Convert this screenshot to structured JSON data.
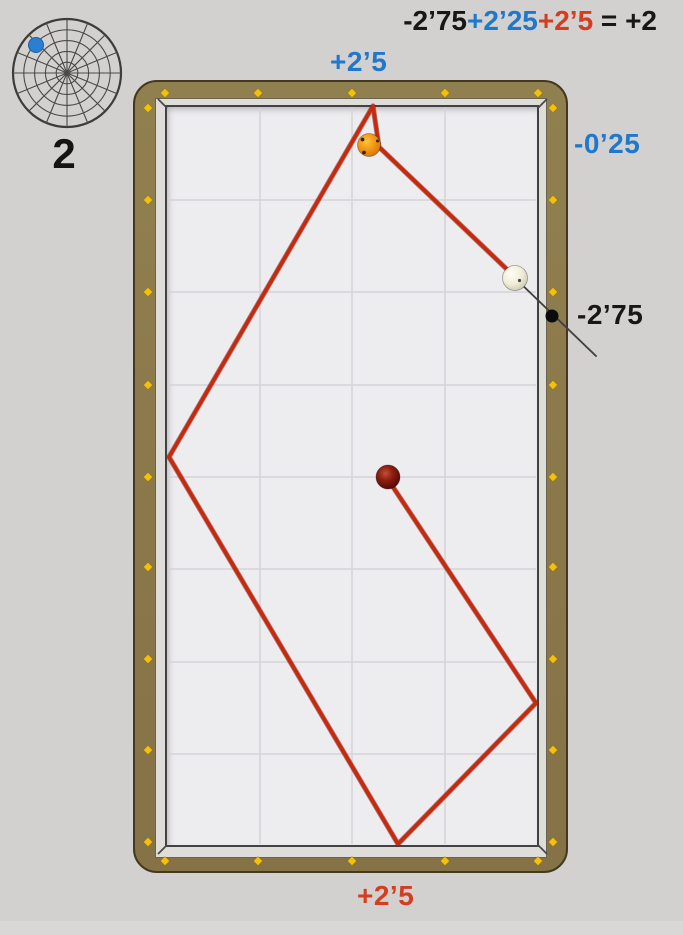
{
  "title_context": "three-cushion billiards diamond-system diagram",
  "shot_number": "2",
  "formula": {
    "segments": [
      {
        "text": "-2’75",
        "color": "#171717"
      },
      {
        "text": "+2’25",
        "color": "#2078cc"
      },
      {
        "text": "+2’5",
        "color": "#d43d20"
      },
      {
        "text": " = +2",
        "color": "#171717"
      }
    ]
  },
  "labels": {
    "top_rail": {
      "text": "+2’5",
      "color": "#2078cc"
    },
    "right_rail_upper": {
      "text": "-0’25",
      "color": "#2078cc"
    },
    "right_rail_lower": {
      "text": "-2’75",
      "color": "#171717"
    },
    "bottom_rail": {
      "text": "+2’5",
      "color": "#d43d20"
    }
  },
  "colors": {
    "background": "#d3d1cf",
    "frame_wood": "#8d7b4d",
    "frame_outline": "#43391f",
    "cushion_strip": "#dfddda",
    "surface": "#edecef",
    "grid_line": "#d4d3d8",
    "diamond_yellow": "#f2c10d",
    "path_red": "#c5290e",
    "aim_black": "#404040",
    "indicator_blue": "#2b7fd0"
  },
  "table_geometry": {
    "surface": {
      "x": 167,
      "y": 107,
      "w": 370,
      "h": 738
    },
    "grid": {
      "verticals": [
        260,
        352,
        445
      ],
      "horizontals": [
        200,
        292,
        385,
        477,
        569,
        662,
        754
      ]
    },
    "diamonds": {
      "top_y": 93,
      "bottom_y": 861,
      "rail_xs": [
        165,
        258,
        352,
        445,
        538
      ],
      "left_x": 148,
      "right_x": 553,
      "rail_ys": [
        108,
        200,
        292,
        385,
        477,
        567,
        659,
        750,
        842
      ]
    },
    "bevels": [
      [
        167,
        108,
        158,
        99
      ],
      [
        538,
        108,
        547,
        99
      ],
      [
        167,
        845,
        158,
        854
      ],
      [
        538,
        845,
        547,
        854
      ]
    ]
  },
  "cue_path": {
    "points": "516,278 379,147 373,106 169,457 398,844 536,703 393,487"
  },
  "aim_line": {
    "x1": 517,
    "y1": 280,
    "x2": 596,
    "y2": 356
  },
  "aim_dot": {
    "cx": 552,
    "cy": 316,
    "r": 6.5
  },
  "balls": {
    "white": {
      "cx": 515,
      "cy": 278,
      "r": 12.5
    },
    "orange": {
      "cx": 369,
      "cy": 145,
      "r": 11.5
    },
    "red": {
      "cx": 388,
      "cy": 477,
      "r": 12
    }
  },
  "polar": {
    "cx": 67,
    "cy": 69,
    "r": 54,
    "rings": 5,
    "spokes": 16,
    "dot": {
      "cx": 36,
      "cy": 41,
      "r": 7.5
    }
  }
}
